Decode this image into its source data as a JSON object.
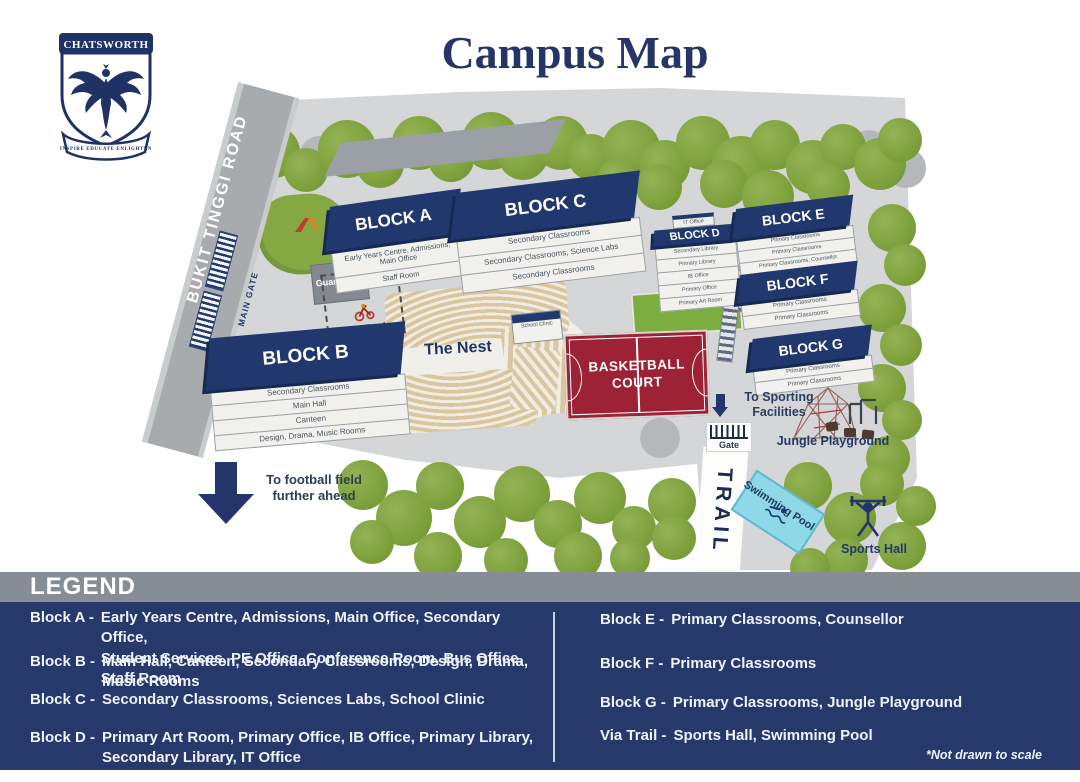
{
  "title": "Campus Map",
  "logo": {
    "school_name": "CHATSWORTH",
    "motto": "INSPIRE EDUCATE ENLIGHTEN"
  },
  "map": {
    "road": "BUKIT TINGGI ROAD",
    "main_gate": "MAIN GATE",
    "guard_post": "Guard Post",
    "bike_track": "Bike Track",
    "nest": "The Nest",
    "school_clinic": "School Clinic",
    "basketball_court": "BASKETBALL COURT",
    "to_sporting": "To Sporting Facilities",
    "gate": "Gate",
    "trail": "TRAIL",
    "jungle_playground": "Jungle Playground",
    "swimming_pool": "Swimming Pool",
    "sports_hall": "Sports Hall",
    "football": "To football field further ahead",
    "blocks": {
      "a": {
        "name": "BLOCK A",
        "floors": [
          "Early Years Centre, Admissions, Main Office",
          "Staff Room"
        ]
      },
      "b": {
        "name": "BLOCK B",
        "floors": [
          "Secondary Classrooms",
          "Main Hall",
          "Canteen",
          "Design, Drama, Music Rooms"
        ]
      },
      "c": {
        "name": "BLOCK C",
        "floors": [
          "Secondary Classrooms",
          "Secondary Classrooms, Science Labs",
          "Secondary Classrooms"
        ]
      },
      "d": {
        "name": "BLOCK D",
        "rooftop": "IT Office",
        "floors": [
          "Secondary Library",
          "Primary Library",
          "IB Office",
          "Primary Office",
          "Primary Art Room"
        ]
      },
      "e": {
        "name": "BLOCK E",
        "floors": [
          "Primary Classrooms",
          "Primary Classrooms",
          "Primary Classrooms, Counsellor"
        ]
      },
      "f": {
        "name": "BLOCK F",
        "floors": [
          "Primary Classrooms",
          "Primary Classrooms"
        ]
      },
      "g": {
        "name": "BLOCK G",
        "floors": [
          "Primary Classrooms",
          "Primary Classrooms"
        ]
      }
    }
  },
  "legend": {
    "title": "LEGEND",
    "note": "*Not drawn to scale",
    "left": [
      {
        "label": "Block A -",
        "desc": "Early Years Centre, Admissions, Main Office, Secondary Office,\nStudent Services, PE Office, Conference Room, Bus Office, Staff Room"
      },
      {
        "label": "Block B -",
        "desc": "Main Hall, Canteen, Secondary Classrooms, Design, Drama, Music Rooms"
      },
      {
        "label": "Block C -",
        "desc": "Secondary Classrooms, Sciences Labs, School Clinic"
      },
      {
        "label": "Block D -",
        "desc": "Primary Art Room, Primary Office, IB Office, Primary Library,\nSecondary Library, IT Office"
      }
    ],
    "right": [
      {
        "label": "Block E -",
        "desc": "Primary Classrooms, Counsellor"
      },
      {
        "label": "Block F -",
        "desc": "Primary Classrooms"
      },
      {
        "label": "Block G -",
        "desc": "Primary Classrooms, Jungle Playground"
      },
      {
        "label": "Via Trail -",
        "desc": "Sports Hall, Swimming Pool"
      }
    ]
  },
  "colors": {
    "navy": "#20386e",
    "legend_bg": "#27386b",
    "header_gray": "#868d95",
    "court_red": "#9d2235",
    "tree_green": "#7da03c",
    "pool_blue": "#8fd8e8",
    "ground_gray": "#d4d6d8"
  }
}
